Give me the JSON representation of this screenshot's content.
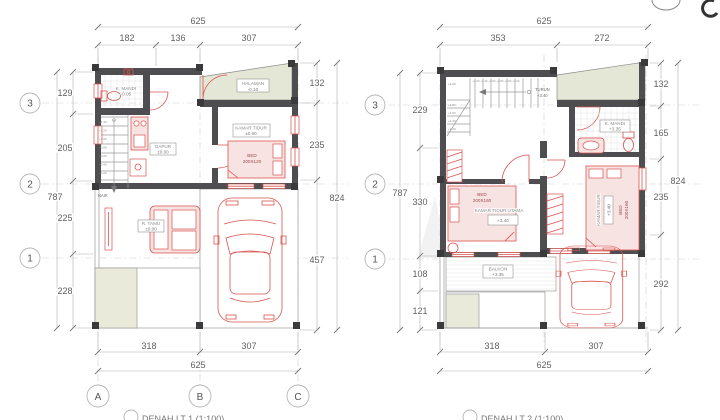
{
  "colors": {
    "wall": "#4e4e50",
    "red_accent": "#d9534f",
    "yard_green": "#e5e7d6",
    "garden_beige": "#eaeadb",
    "dim_text": "#606060"
  },
  "plan1": {
    "caption": "DENAH LT 1 (1:100)",
    "grid_rows": [
      "3",
      "2",
      "1"
    ],
    "grid_cols": [
      "A",
      "B",
      "C"
    ],
    "dims": {
      "top": {
        "overall": "625",
        "segments": [
          "182",
          "136",
          "307"
        ]
      },
      "left": {
        "overall": "787",
        "segments": [
          "129",
          "205",
          "225",
          "228"
        ]
      },
      "right": {
        "overall": "824",
        "segments": [
          "132",
          "235",
          "457"
        ]
      },
      "bottom": {
        "overall": "625",
        "segments": [
          "318",
          "307"
        ]
      }
    },
    "rooms": {
      "halaman": {
        "name": "HALAMAN",
        "level": "-0.10"
      },
      "kmandi": {
        "name": "K. MANDI",
        "level": "-0.05"
      },
      "dapur": {
        "name": "DAPUR",
        "level": "±0.00"
      },
      "kamar_tidur": {
        "name": "KAMAR TIDUR",
        "level": "±0.00"
      },
      "r_tamu": {
        "name": "R. TAMU",
        "level": "±0.00"
      }
    },
    "bed": {
      "line1": "BED",
      "line2": "200X120"
    },
    "stairs": {
      "label": "NAIK",
      "steps": [
        "+1.40",
        "+1.20",
        "+1.00",
        "+0.80",
        "+0.60",
        "+0.40",
        "+0.20"
      ]
    }
  },
  "plan2": {
    "caption": "DENAH LT 2 (1:100)",
    "grid_rows": [
      "3",
      "2",
      "1"
    ],
    "dims": {
      "top": {
        "overall": "625",
        "segments": [
          "353",
          "272"
        ]
      },
      "left": {
        "overall": "787",
        "segments": [
          "229",
          "330",
          "108",
          "121"
        ]
      },
      "right": {
        "overall": "824",
        "segments": [
          "132",
          "165",
          "235",
          "292"
        ]
      },
      "bottom": {
        "overall": "625",
        "segments": [
          "318",
          "307"
        ]
      }
    },
    "rooms": {
      "kmandi": {
        "name": "K. MANDI",
        "level": "+3.35"
      },
      "kt_utama": {
        "name": "KAMAR TIDUR UTAMA",
        "level": "+3.40"
      },
      "kamar_tidur": {
        "name": "KAMAR TIDUR",
        "level": "+3.40"
      },
      "balkon": {
        "name": "BALKON",
        "level": "+3.35"
      }
    },
    "bed_utama": {
      "line1": "BED",
      "line2": "200X160"
    },
    "bed2": {
      "line1": "BED",
      "line2": "200X160"
    },
    "stairs": {
      "label": "TURUN",
      "level": "+3.40",
      "steps_top": [
        "+2.20",
        "+2.40",
        "+2.60",
        "+2.80",
        "+3.00",
        "+3.20"
      ],
      "steps_left": [
        "+2.00",
        "+1.80",
        "+1.60",
        "+1.40",
        "+1.20"
      ]
    }
  }
}
